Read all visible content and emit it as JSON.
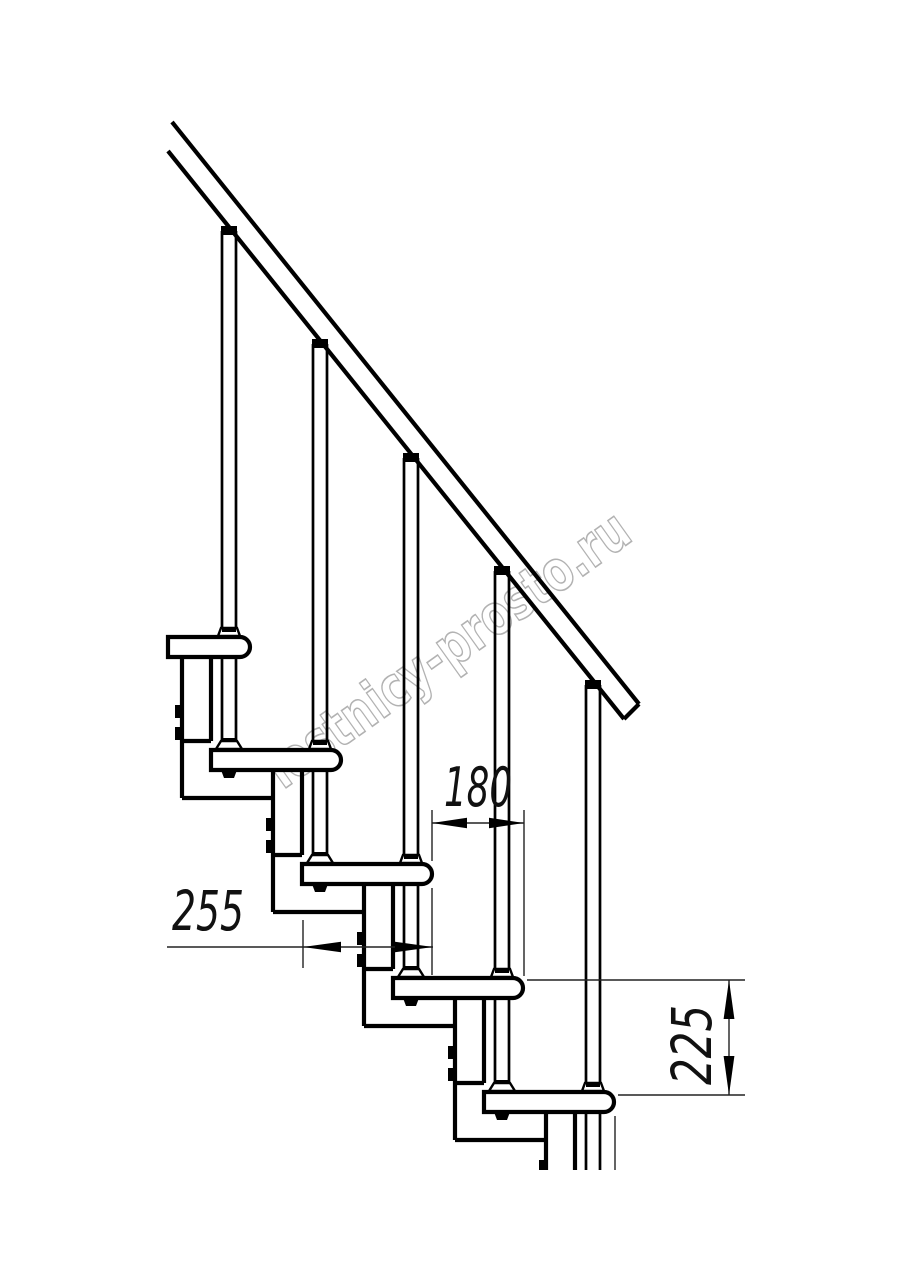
{
  "diagram": {
    "type": "staircase-side-view-technical-drawing",
    "watermark": "lestnicy-prosto.ru",
    "colors": {
      "line": "#000000",
      "dimension_line": "#222222",
      "watermark": "#b2b2b2",
      "background": "#ffffff"
    },
    "dimensions": {
      "tread_depth": "255",
      "step_run": "180",
      "riser_height": "225"
    }
  }
}
